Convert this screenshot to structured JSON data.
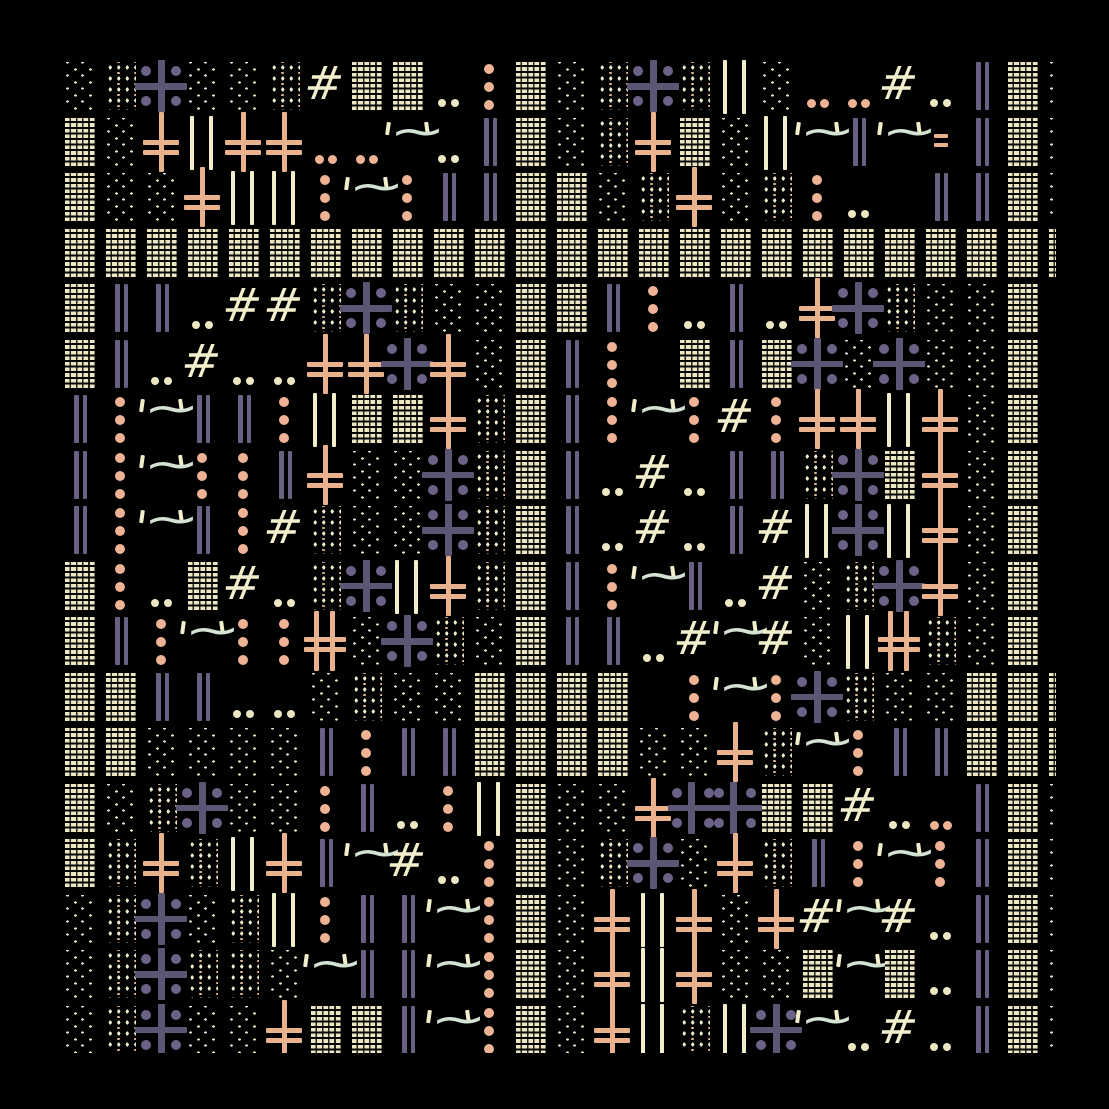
{
  "canvas": {
    "width": 1109,
    "height": 1109,
    "background": "#000000"
  },
  "palette": {
    "cream": "#ece7c2",
    "cream_bright": "#f2eecb",
    "mint": "#d3e3d3",
    "salmon": "#e9b18c",
    "salmon_dot": "#edb394",
    "purple": "#6a6084",
    "purple_deep": "#5d5574",
    "purple_dot": "#6c6287",
    "black": "#000000"
  },
  "glyphs": {
    "hash": "#",
    "tilde": "~",
    "quote": "'"
  },
  "grid": {
    "cols": 25,
    "rows": 18,
    "origin_x": 65,
    "origin_y": 62,
    "pitch_x": 41,
    "pitch_y": 55.5,
    "tile_width": 28,
    "tile_height": 48,
    "clip": {
      "left": 62,
      "top": 50,
      "right": 1056,
      "bottom": 1053
    }
  },
  "legend": {
    "W": "weave-block",
    "S": "sparse-dot-grid",
    "M": "dense-dot-grid",
    "P": "purple-plus-with-dots",
    "D": "purple-double-plus",
    "X": "salmon-double-cross",
    "Y": "salmon-double-cross-pair",
    "B": "purple-bar-pair",
    "C": "cream-bar-pair",
    "I": "purple-bar-single",
    "V": "salmon-dot-column",
    "2": "cream-dot-pair",
    "3": "salmon-dot-pair",
    "T": "quoted-tilde",
    "H": "hash-glyph",
    "E": "salmon-dash-pair",
    "_": "empty"
  },
  "rows": [
    [
      "S",
      "M",
      "P",
      "S",
      "S",
      "M",
      "H",
      "W",
      "W",
      "2",
      "V",
      "W",
      "S",
      "M",
      "P",
      "M",
      "C",
      "S",
      "3",
      "3",
      "H",
      "2",
      "B",
      "W",
      "S"
    ],
    [
      "W",
      "S",
      "X",
      "C",
      "X",
      "X",
      "3",
      "3",
      "T",
      "2",
      "B",
      "W",
      "S",
      "M",
      "X",
      "W",
      "S",
      "C",
      "T",
      "B",
      "T",
      "E",
      "B",
      "W",
      "S"
    ],
    [
      "W",
      "S",
      "S",
      "X",
      "C",
      "C",
      "V",
      "T",
      "V",
      "B",
      "B",
      "W",
      "W",
      "S",
      "M",
      "X",
      "S",
      "M",
      "V",
      "2",
      "_",
      "B",
      "B",
      "W",
      "S"
    ],
    [
      "W",
      "W",
      "W",
      "W",
      "W",
      "W",
      "W",
      "W",
      "W",
      "W",
      "W",
      "W",
      "W",
      "W",
      "W",
      "W",
      "W",
      "W",
      "W",
      "W",
      "W",
      "W",
      "W",
      "W",
      "W"
    ],
    [
      "W",
      "B",
      "B",
      "2",
      "H",
      "H",
      "M",
      "P",
      "M",
      "S",
      "S",
      "W",
      "W",
      "B",
      "V",
      "2",
      "B",
      "2",
      "X",
      "P",
      "M",
      "S",
      "S",
      "W",
      "I"
    ],
    [
      "W",
      "B",
      "2",
      "H",
      "2",
      "2",
      "X",
      "X",
      "P",
      "X",
      "S",
      "W",
      "B",
      "V",
      "_",
      "W",
      "B",
      "W",
      "P",
      "S",
      "P",
      "S",
      "S",
      "W",
      "I"
    ],
    [
      "B",
      "V",
      "T",
      "B",
      "B",
      "V",
      "C",
      "W",
      "W",
      "X",
      "M",
      "W",
      "B",
      "V",
      "T",
      "V",
      "H",
      "V",
      "X",
      "X",
      "C",
      "X",
      "S",
      "W",
      "I"
    ],
    [
      "B",
      "V",
      "T",
      "V",
      "V",
      "B",
      "X",
      "S",
      "S",
      "P",
      "M",
      "W",
      "B",
      "2",
      "H",
      "2",
      "B",
      "B",
      "M",
      "P",
      "W",
      "X",
      "S",
      "W",
      "V"
    ],
    [
      "B",
      "V",
      "T",
      "B",
      "V",
      "H",
      "M",
      "S",
      "S",
      "P",
      "M",
      "W",
      "B",
      "2",
      "H",
      "2",
      "B",
      "H",
      "C",
      "P",
      "C",
      "X",
      "S",
      "W",
      "V"
    ],
    [
      "W",
      "V",
      "2",
      "W",
      "H",
      "2",
      "M",
      "P",
      "C",
      "X",
      "M",
      "W",
      "B",
      "V",
      "T",
      "B",
      "2",
      "H",
      "S",
      "M",
      "P",
      "X",
      "S",
      "W",
      "I"
    ],
    [
      "W",
      "B",
      "V",
      "T",
      "V",
      "V",
      "Y",
      "S",
      "P",
      "M",
      "S",
      "W",
      "B",
      "B",
      "2",
      "H",
      "T",
      "H",
      "S",
      "C",
      "Y",
      "M",
      "S",
      "W",
      "I"
    ],
    [
      "W",
      "W",
      "B",
      "B",
      "2",
      "2",
      "S",
      "M",
      "S",
      "S",
      "W",
      "W",
      "W",
      "W",
      "_",
      "V",
      "T",
      "V",
      "P",
      "M",
      "S",
      "S",
      "W",
      "W",
      "W"
    ],
    [
      "W",
      "W",
      "S",
      "S",
      "S",
      "S",
      "B",
      "V",
      "B",
      "B",
      "W",
      "W",
      "W",
      "W",
      "S",
      "S",
      "X",
      "M",
      "T",
      "V",
      "B",
      "B",
      "W",
      "W",
      "W"
    ],
    [
      "W",
      "S",
      "M",
      "P",
      "S",
      "S",
      "V",
      "B",
      "2",
      "V",
      "C",
      "W",
      "S",
      "S",
      "X",
      "D",
      "_",
      "W",
      "W",
      "H",
      "2",
      "3",
      "B",
      "W",
      "S"
    ],
    [
      "W",
      "M",
      "X",
      "M",
      "C",
      "X",
      "B",
      "T",
      "H",
      "2",
      "V",
      "W",
      "S",
      "M",
      "P",
      "S",
      "X",
      "M",
      "B",
      "V",
      "T",
      "V",
      "B",
      "W",
      "S"
    ],
    [
      "S",
      "M",
      "P",
      "S",
      "M",
      "C",
      "V",
      "B",
      "B",
      "T",
      "V",
      "W",
      "S",
      "X",
      "C",
      "X",
      "S",
      "X",
      "H",
      "T",
      "H",
      "2",
      "B",
      "W",
      "S"
    ],
    [
      "S",
      "M",
      "P",
      "M",
      "M",
      "S",
      "T",
      "B",
      "B",
      "T",
      "V",
      "W",
      "S",
      "X",
      "C",
      "X",
      "S",
      "S",
      "W",
      "T",
      "W",
      "2",
      "B",
      "W",
      "S"
    ],
    [
      "S",
      "M",
      "P",
      "S",
      "S",
      "X",
      "W",
      "W",
      "B",
      "T",
      "V",
      "W",
      "S",
      "X",
      "C",
      "M",
      "C",
      "P",
      "T",
      "2",
      "H",
      "2",
      "B",
      "W",
      "S"
    ]
  ]
}
